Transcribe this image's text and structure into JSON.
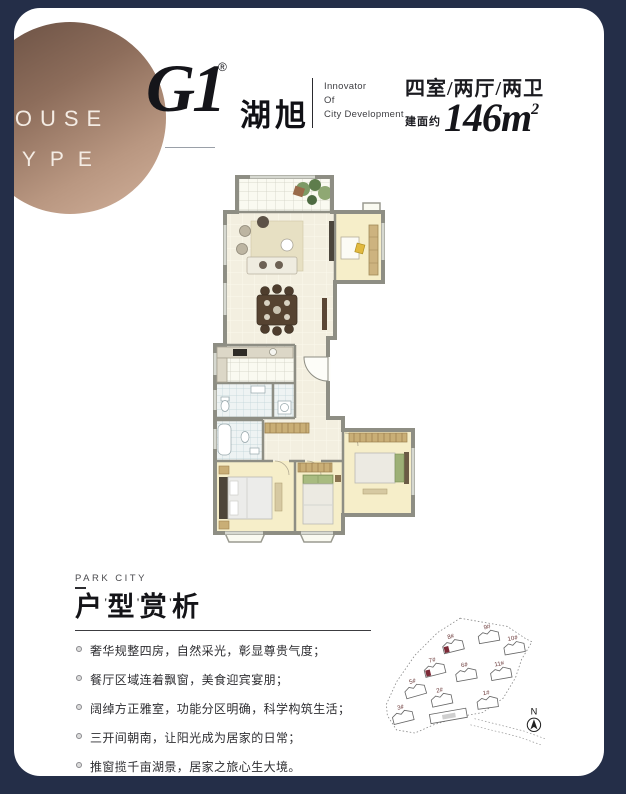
{
  "colors": {
    "frame_navy": "#242e48",
    "page_white": "#ffffff",
    "badge_copper_dark": "#6b5144",
    "badge_copper_light": "#d2b19b",
    "siteplan_highlight": "#7d2b38",
    "siteplan_label": "#6b3a3a"
  },
  "badge": {
    "line1": "HOUSE",
    "line2": "TYPE"
  },
  "logo": {
    "mark": "G1",
    "registered": "®",
    "name_cjk": "湖旭",
    "tagline": [
      "Innovator",
      "Of",
      "City Development"
    ]
  },
  "spec": {
    "rooms": "四室/两厅/两卫",
    "area_label": "建面约",
    "area_value": "146m",
    "area_sup": "2"
  },
  "analysis": {
    "eyebrow": "PARK CITY",
    "title_chars": [
      "户",
      "型",
      "赏",
      "析"
    ],
    "tick": "'",
    "bullets": [
      "奢华规整四房，自然采光，彰显尊贵气度；",
      "餐厅区域连着飘窗，美食迎宾宴朋；",
      "阔绰方正雅室，功能分区明确，科学构筑生活；",
      "三开间朝南，让阳光成为居家的日常；",
      "推窗揽千亩湖景，居家之旅心生大境。"
    ]
  },
  "siteplan": {
    "north_label": "N",
    "buildings": [
      {
        "label": "8#",
        "x": 68,
        "y": 28,
        "rot": -14,
        "hl": true,
        "type": "std"
      },
      {
        "label": "9#",
        "x": 103,
        "y": 18,
        "rot": -10,
        "hl": false,
        "type": "std"
      },
      {
        "label": "10#",
        "x": 128,
        "y": 29,
        "rot": -10,
        "hl": false,
        "type": "std"
      },
      {
        "label": "7#",
        "x": 50,
        "y": 51,
        "rot": -14,
        "hl": true,
        "type": "std"
      },
      {
        "label": "6#",
        "x": 81,
        "y": 55,
        "rot": -10,
        "hl": false,
        "type": "std"
      },
      {
        "label": "11#",
        "x": 115,
        "y": 54,
        "rot": -10,
        "hl": false,
        "type": "std"
      },
      {
        "label": "5#",
        "x": 31,
        "y": 72,
        "rot": -16,
        "hl": false,
        "type": "std"
      },
      {
        "label": "2#",
        "x": 57,
        "y": 80,
        "rot": -12,
        "hl": false,
        "type": "std"
      },
      {
        "label": "1#",
        "x": 102,
        "y": 82,
        "rot": -8,
        "hl": false,
        "type": "std"
      },
      {
        "label": "3#",
        "x": 19,
        "y": 97,
        "rot": -14,
        "hl": false,
        "type": "std"
      },
      {
        "label": "",
        "x": 56,
        "y": 98,
        "rot": -10,
        "hl": false,
        "type": "long"
      }
    ]
  }
}
